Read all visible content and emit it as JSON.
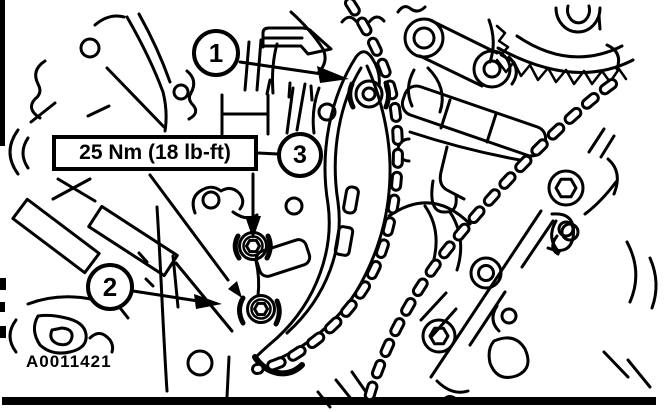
{
  "figure": {
    "code": "A0011421",
    "torque_label": "25 Nm (18 lb-ft)",
    "callouts": [
      {
        "number": "1"
      },
      {
        "number": "2"
      },
      {
        "number": "3"
      }
    ],
    "colors": {
      "line": "#000000",
      "background": "#ffffff"
    }
  }
}
